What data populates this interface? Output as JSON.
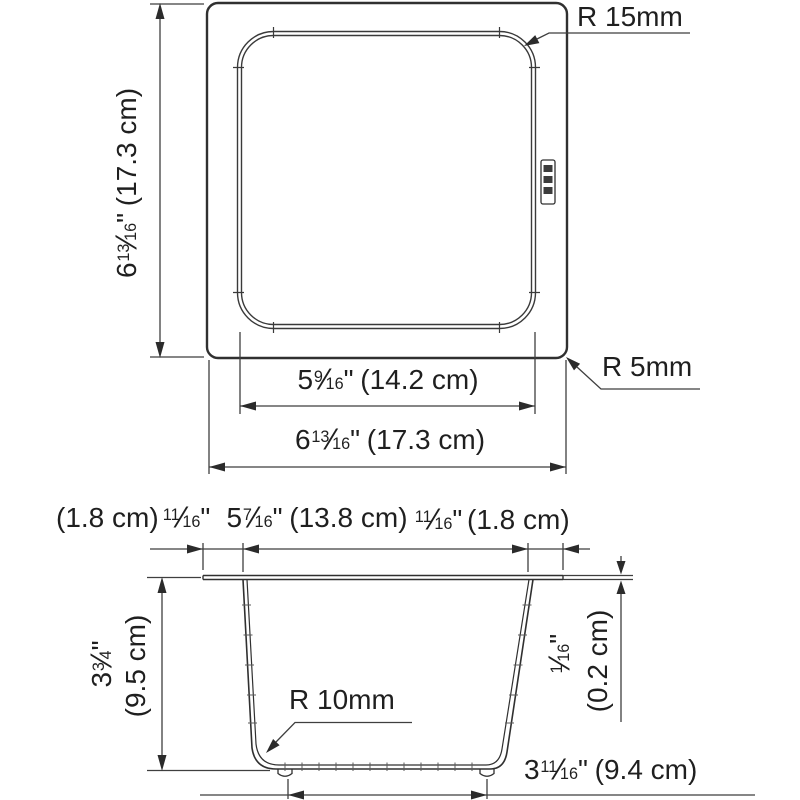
{
  "meta": {
    "slash": "⁄",
    "inch": "\"",
    "background_color": "#ffffff",
    "line_color": "#303030",
    "dim_line_color": "#3f3f3f",
    "text_color": "#1f1f1f"
  },
  "top_view": {
    "height_dim": {
      "whole": "6",
      "num": "13",
      "den": "16",
      "metric": "(17.3 cm)"
    },
    "inner_corner_radius_label": "R 15mm",
    "outer_corner_radius_label": "R 5mm",
    "inner_width_dim": {
      "whole": "5",
      "num": "9",
      "den": "16",
      "metric": "(14.2 cm)"
    },
    "outer_width_dim": {
      "whole": "6",
      "num": "13",
      "den": "16",
      "metric": "(17.3 cm)"
    },
    "brand_logo_icon": "franke-logo"
  },
  "cross_section": {
    "left_flange_metric": "(1.8 cm)",
    "left_flange_dim": {
      "num": "11",
      "den": "16"
    },
    "top_width_dim": {
      "whole": "5",
      "num": "7",
      "den": "16",
      "metric": "(13.8 cm)"
    },
    "right_flange_dim": {
      "num": "11",
      "den": "16"
    },
    "right_flange_metric": "(1.8 cm)",
    "depth_dim": {
      "whole": "3",
      "num": "3",
      "den": "4"
    },
    "depth_metric": "(9.5 cm)",
    "bottom_radius_label": "R 10mm",
    "thickness_dim": {
      "num": "1",
      "den": "16"
    },
    "thickness_metric": "(0.2 cm)",
    "bottom_width_dim": {
      "whole": "3",
      "num": "11",
      "den": "16",
      "metric": "(9.4 cm)"
    }
  }
}
